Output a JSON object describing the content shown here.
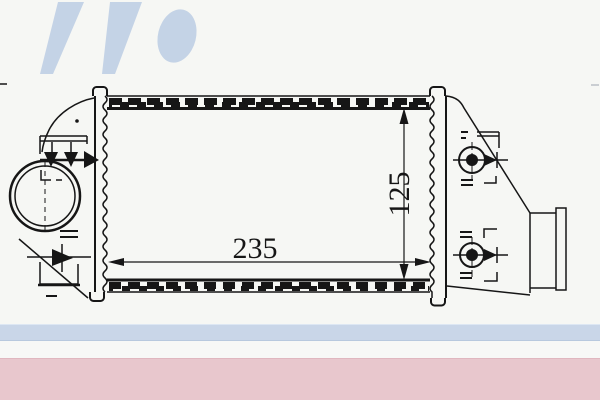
{
  "page": {
    "background_color": "#f6f7f4",
    "description": "parts-catalog technical drawing of an intercooler"
  },
  "watermark": {
    "name": "brand-logo-watermark-fragment",
    "color": "#c4d3e6"
  },
  "drawing": {
    "subject": "intercooler front view with header tanks, inlet pipe and mounting bosses",
    "line_color": "#161616",
    "dimensions": {
      "width_label": "235",
      "height_label": "125"
    }
  },
  "footer": {
    "blue_bar_color": "#c9d6e8",
    "pink_bar_color": "#e8c7cd"
  }
}
